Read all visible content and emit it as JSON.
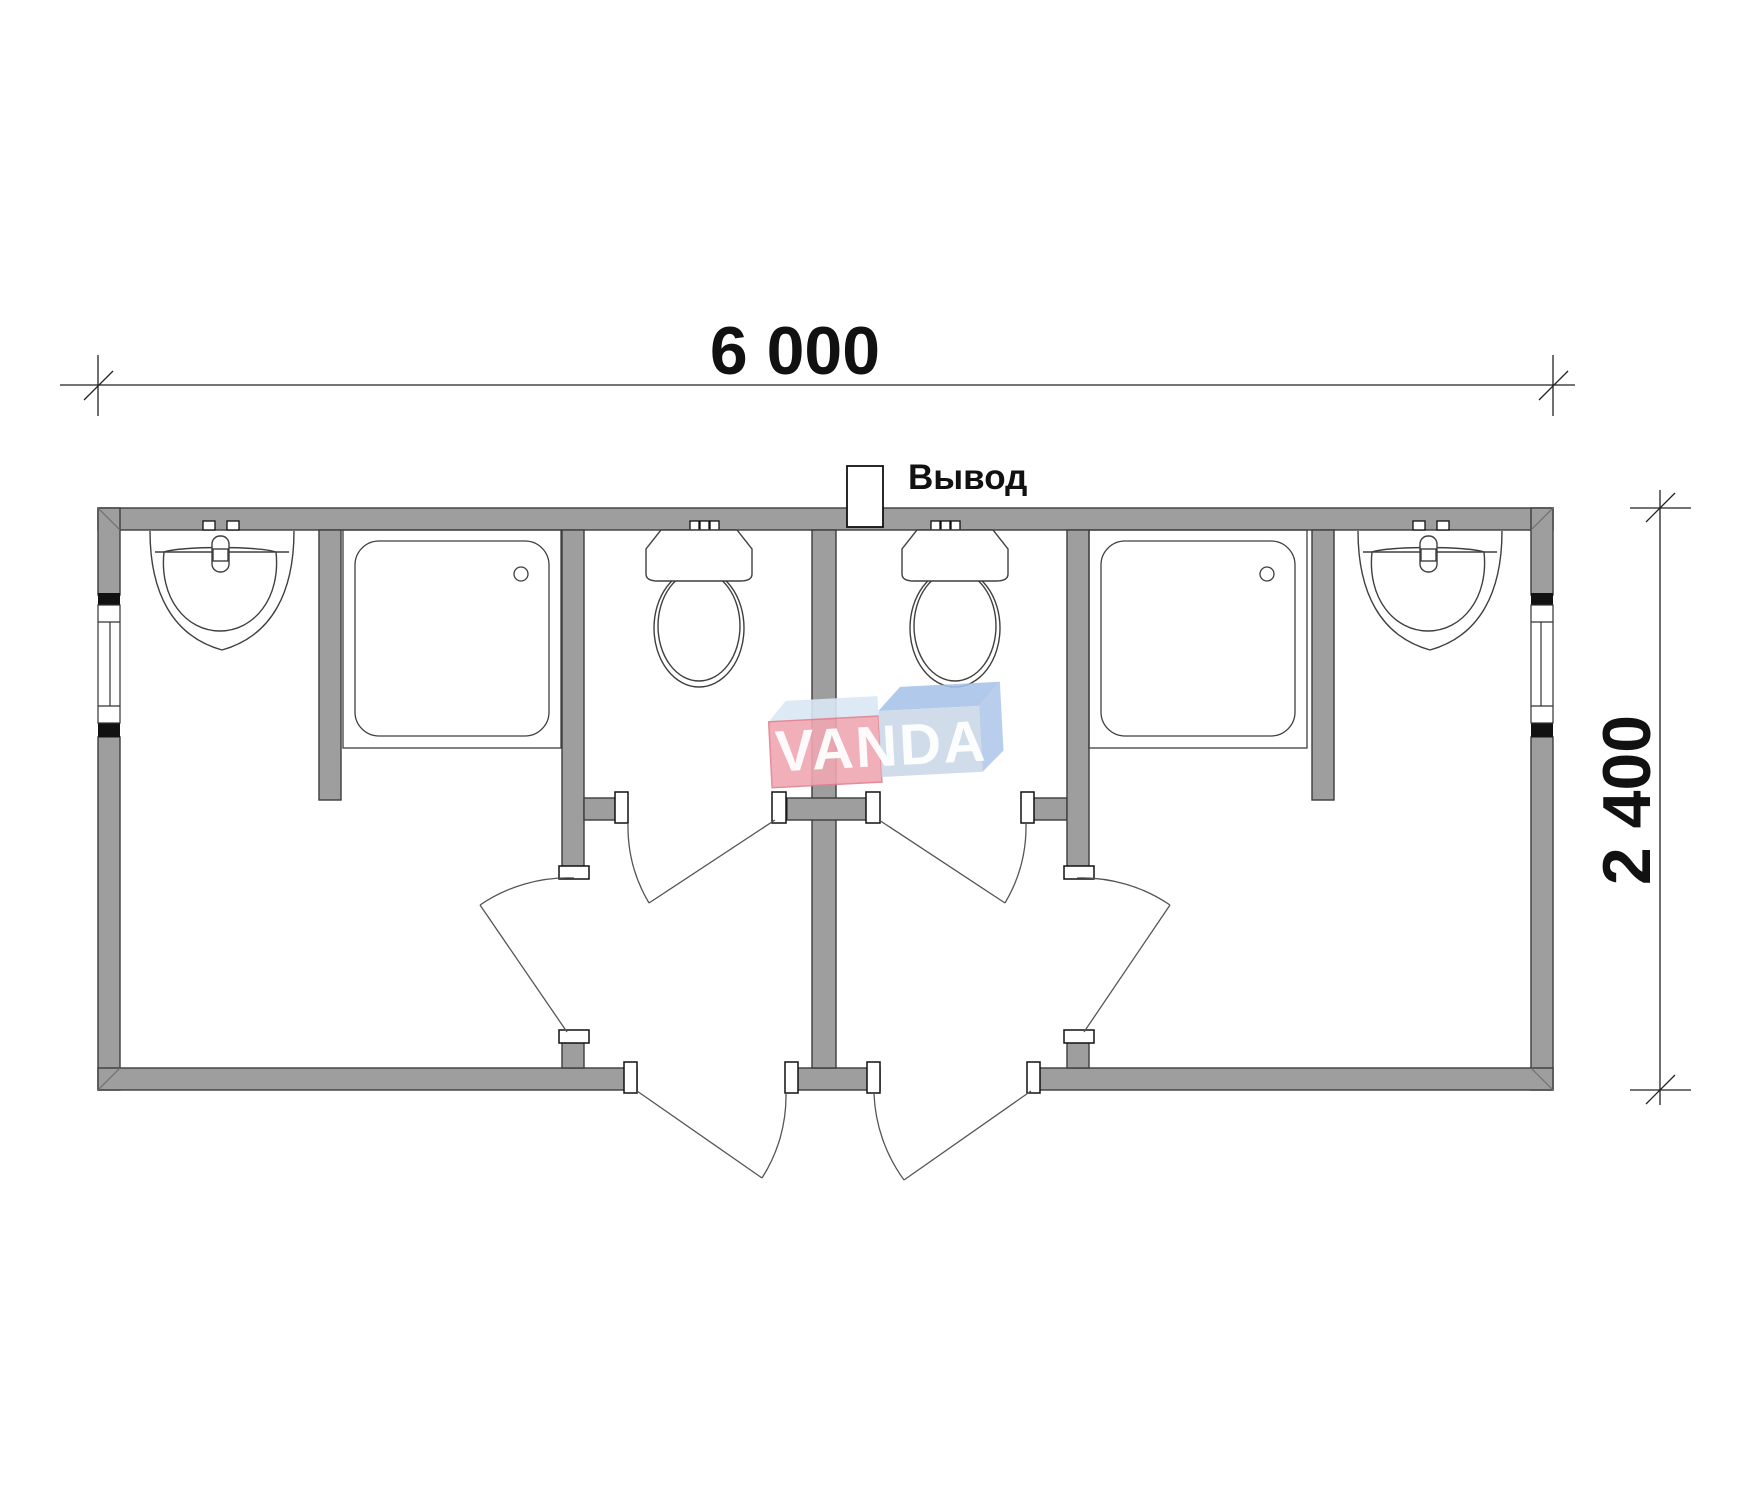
{
  "plan": {
    "width_dimension": "6 000",
    "height_dimension": "2 400",
    "outlet_label": "Вывод",
    "watermark": "VANDA",
    "drawing_type": "sanitary container floor plan, two mirrored units",
    "colors": {
      "wall_fill": "#9e9e9e",
      "wall_outline": "#3c3c3c",
      "line": "#444444",
      "window_cap": "#111111",
      "watermark_pink": "#f0a7b2",
      "watermark_pink_edge": "#e2808f",
      "watermark_light_blue": "#d9e8f4",
      "watermark_periwinkle": "#ccd8e9",
      "watermark_blue": "#a6c2e8",
      "watermark_text": "#ffffff"
    },
    "units": [
      {
        "name": "left-unit",
        "fixtures": [
          "sink",
          "shower",
          "toilet"
        ],
        "doors": [
          "room-door",
          "wc-door",
          "exterior-door"
        ],
        "window": true
      },
      {
        "name": "right-unit",
        "fixtures": [
          "sink",
          "shower",
          "toilet"
        ],
        "doors": [
          "room-door",
          "wc-door",
          "exterior-door"
        ],
        "window": true
      }
    ]
  }
}
